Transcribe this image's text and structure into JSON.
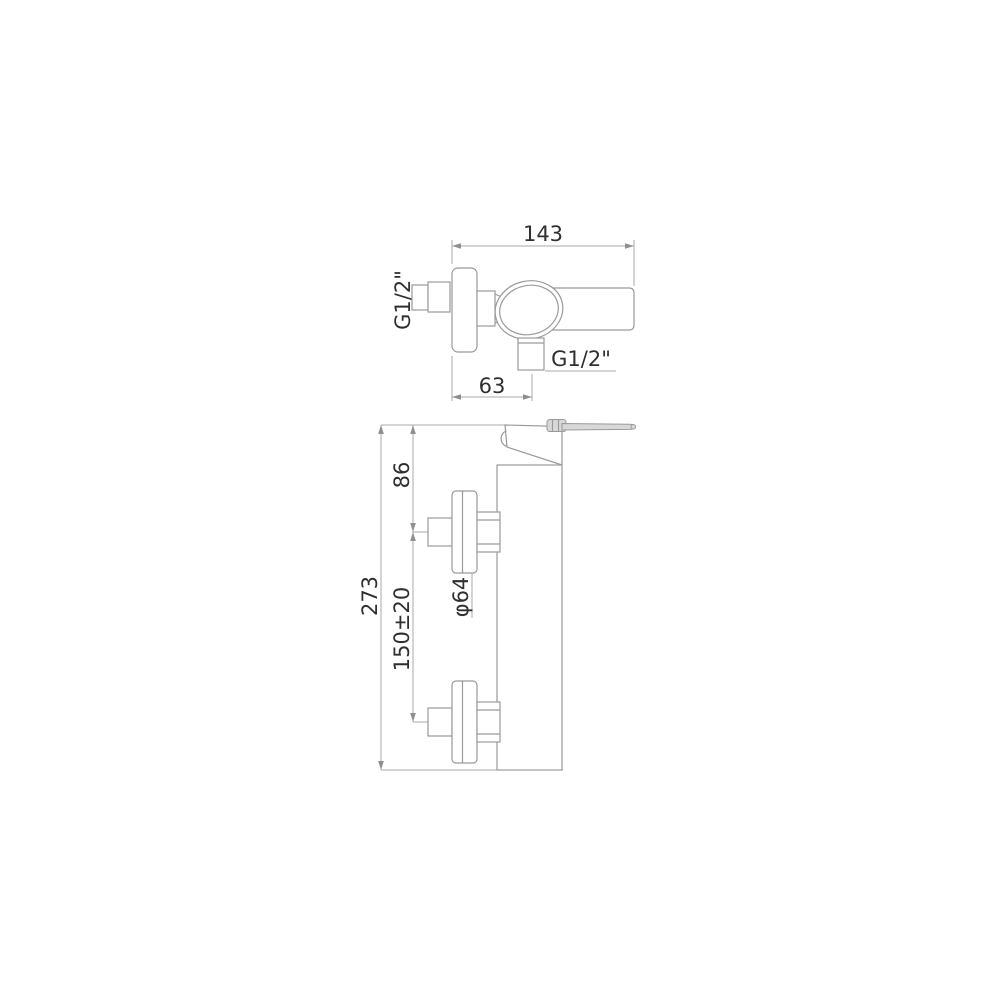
{
  "drawing": {
    "type": "technical-dimension-drawing",
    "subject": "wall-mounted single-lever shower mixer, two orthographic views",
    "colors": {
      "background": "#ffffff",
      "outline": "#9a9a9a",
      "dimension_line": "#a8a8a8",
      "text": "#2f2f2f",
      "lever_fill": "#d8d8d8"
    },
    "top_view": {
      "width_dim": "143",
      "inlet_thread_label": "G1/2\"",
      "outlet_thread_label": "G1/2\"",
      "outlet_offset_dim": "63"
    },
    "front_view": {
      "overall_dim": "273",
      "top_offset_dim": "86",
      "centers_dim": "150±20",
      "escutcheon_diameter_dim": "φ64"
    }
  }
}
